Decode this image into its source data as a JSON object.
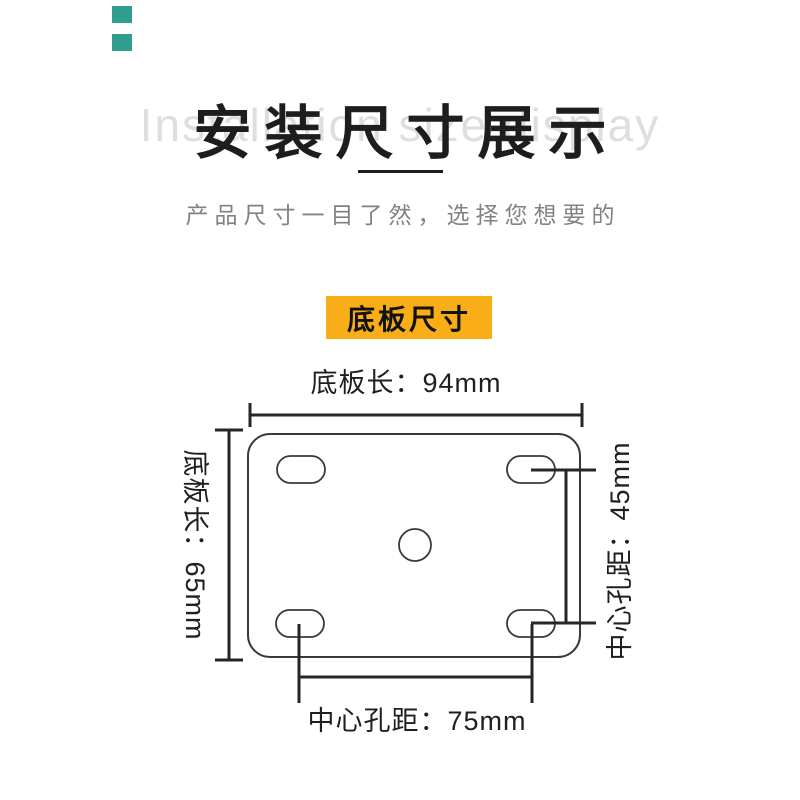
{
  "page": {
    "background_color": "#ffffff",
    "accent_color": "#2f9e8f"
  },
  "header": {
    "background_text": "Installation size display",
    "title": "安装尺寸展示",
    "subtitle": "产品尺寸一目了然，选择您想要的"
  },
  "section_badge": {
    "label": "底板尺寸",
    "background_color": "#f9ae17"
  },
  "diagram": {
    "dim_top": "底板长：94mm",
    "dim_left": "底板长：65mm",
    "dim_right": "中心孔距：45mm",
    "dim_bottom": "中心孔距：75mm",
    "values": {
      "plate_length_mm": 94,
      "plate_width_mm": 65,
      "center_hole_spacing_vertical_mm": 45,
      "center_hole_spacing_horizontal_mm": 75
    }
  }
}
